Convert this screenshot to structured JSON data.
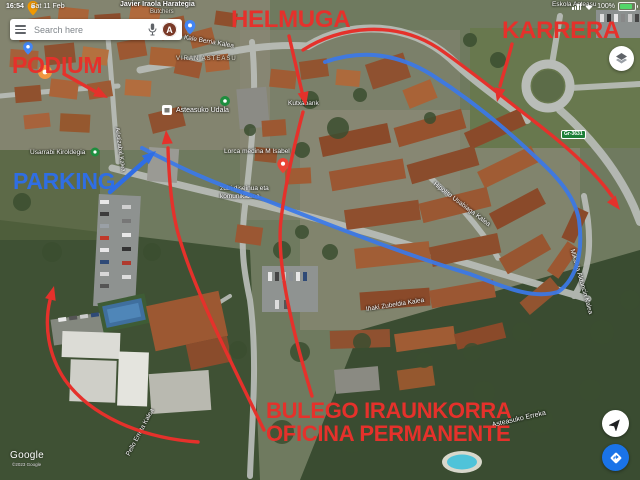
{
  "status_bar": {
    "time": "16:54",
    "date": "Sat 11 Feb",
    "battery_percent": "100%"
  },
  "search": {
    "placeholder": "Search here",
    "avatar_letter": "A"
  },
  "annotations": {
    "podium": "PODIUM",
    "helmuga": "HELMUGA",
    "karrera": "KARRERA",
    "parking": "PARKING",
    "bulego_line1": "BULEGO IRAUNKORRA",
    "bulego_line2": "OFICINA PERMANENTE",
    "red_color": "#e5312b",
    "blue_text_color": "#2f6ee4",
    "route_blue_color": "#3b78e8"
  },
  "map": {
    "labels": [
      {
        "text": "Javier Iraola Harategia"
      },
      {
        "text": "Butchers"
      },
      {
        "text": "Kale Berria Kalea"
      },
      {
        "text": "Eskola Asteasu"
      },
      {
        "text": "VIRAN ASTEASU"
      },
      {
        "text": "Asteasuko Udala"
      },
      {
        "text": "Kutxabank"
      },
      {
        "text": "Lorca medina M Isabel"
      },
      {
        "text": "zubi diseinua eta"
      },
      {
        "text": "komunikazioa"
      },
      {
        "text": "Usarrabi Kiroldegia"
      },
      {
        "text": "Hipolito Usabiaga Kalea"
      },
      {
        "text": "Mikaela Alduncin Kalea"
      },
      {
        "text": "Iñaki Zubeldia Kalea"
      },
      {
        "text": "Asteasuko Erreka"
      },
      {
        "text": "Pello Errota Kalea"
      },
      {
        "text": "Aristizabal Kalea"
      }
    ],
    "road_badge": "Gr-3631",
    "pois": [
      "shopping-pin",
      "blue-pin",
      "blue-pin",
      "park-pin",
      "sports-pin",
      "red-pin",
      "townhall-icon",
      "restaurant-poi"
    ]
  },
  "attribution": {
    "logo": "Google",
    "copyright": "©2023 Google"
  }
}
